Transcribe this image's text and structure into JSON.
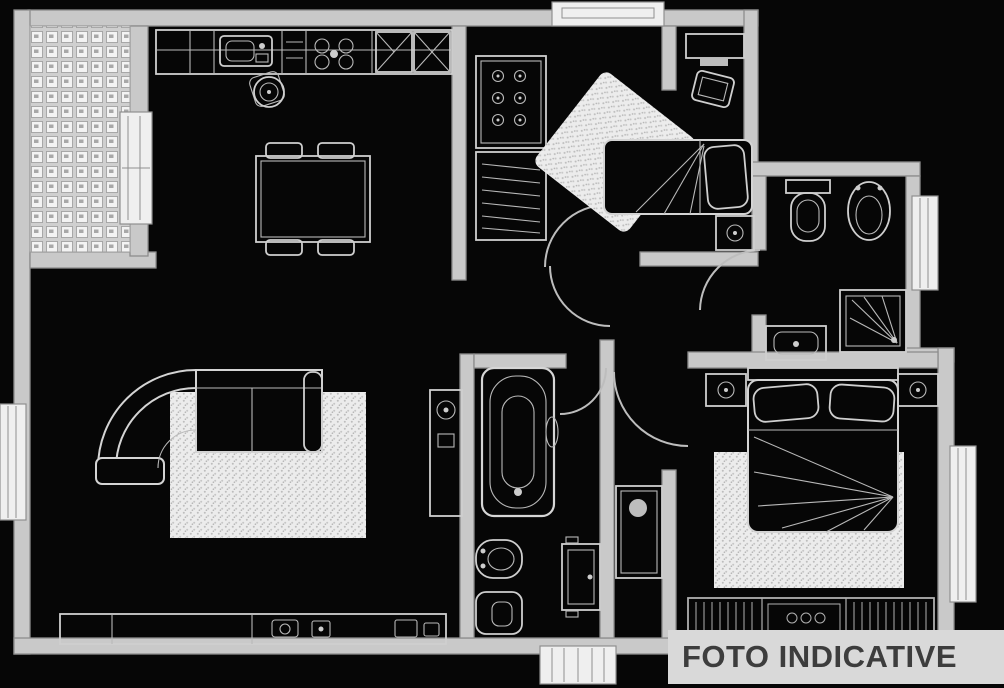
{
  "watermark": {
    "label": "FOTO INDICATIVE"
  },
  "palette": {
    "background": "#060606",
    "wall_fill": "#c9c9c9",
    "wall_stroke": "#8d8d8d",
    "fixture_stroke": "#d4d4d4",
    "texture_fill": "#ececec",
    "watermark_bg": "#d9d9d9",
    "watermark_text": "#3d3d3d"
  }
}
